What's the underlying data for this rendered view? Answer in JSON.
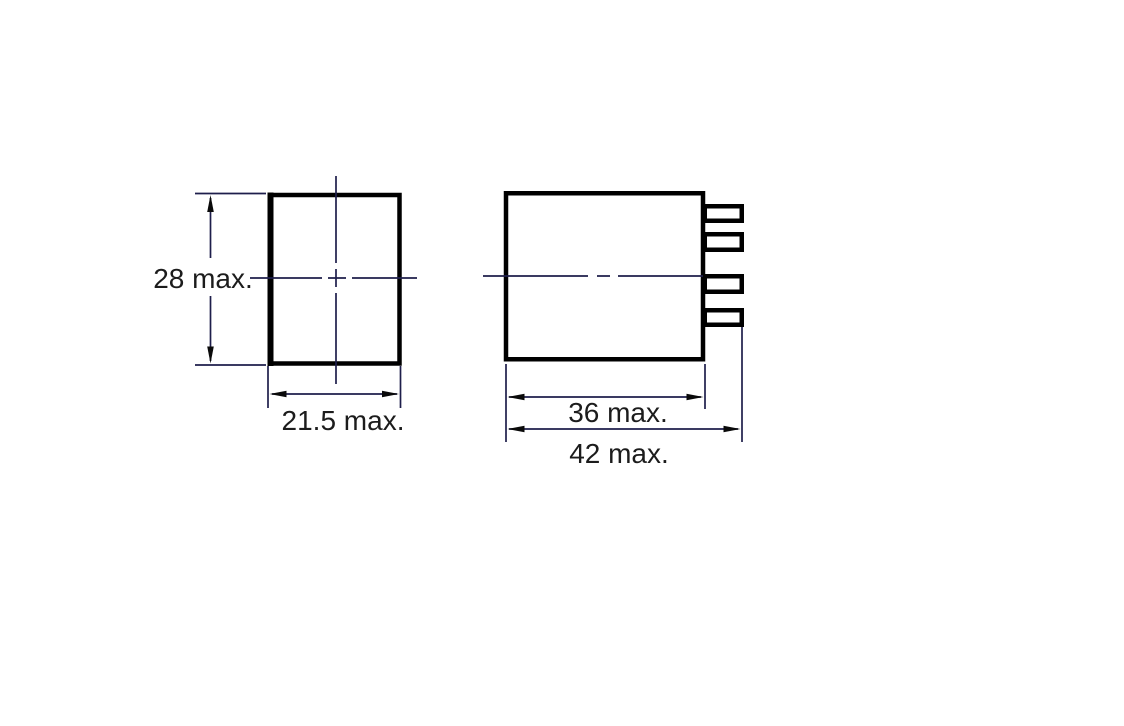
{
  "drawing": {
    "type": "technical dimension drawing",
    "views": {
      "front": {
        "height_dimension": "28 max.",
        "width_dimension": "21.5 max."
      },
      "side": {
        "body_width_dimension": "36 max.",
        "overall_width_dimension": "42 max.",
        "pin_count": 4
      }
    },
    "colors": {
      "background": "#ffffff",
      "body_outline": "#000000",
      "dimension_lines": "#1e1e4b",
      "label_text": "#1c1c1c"
    }
  }
}
